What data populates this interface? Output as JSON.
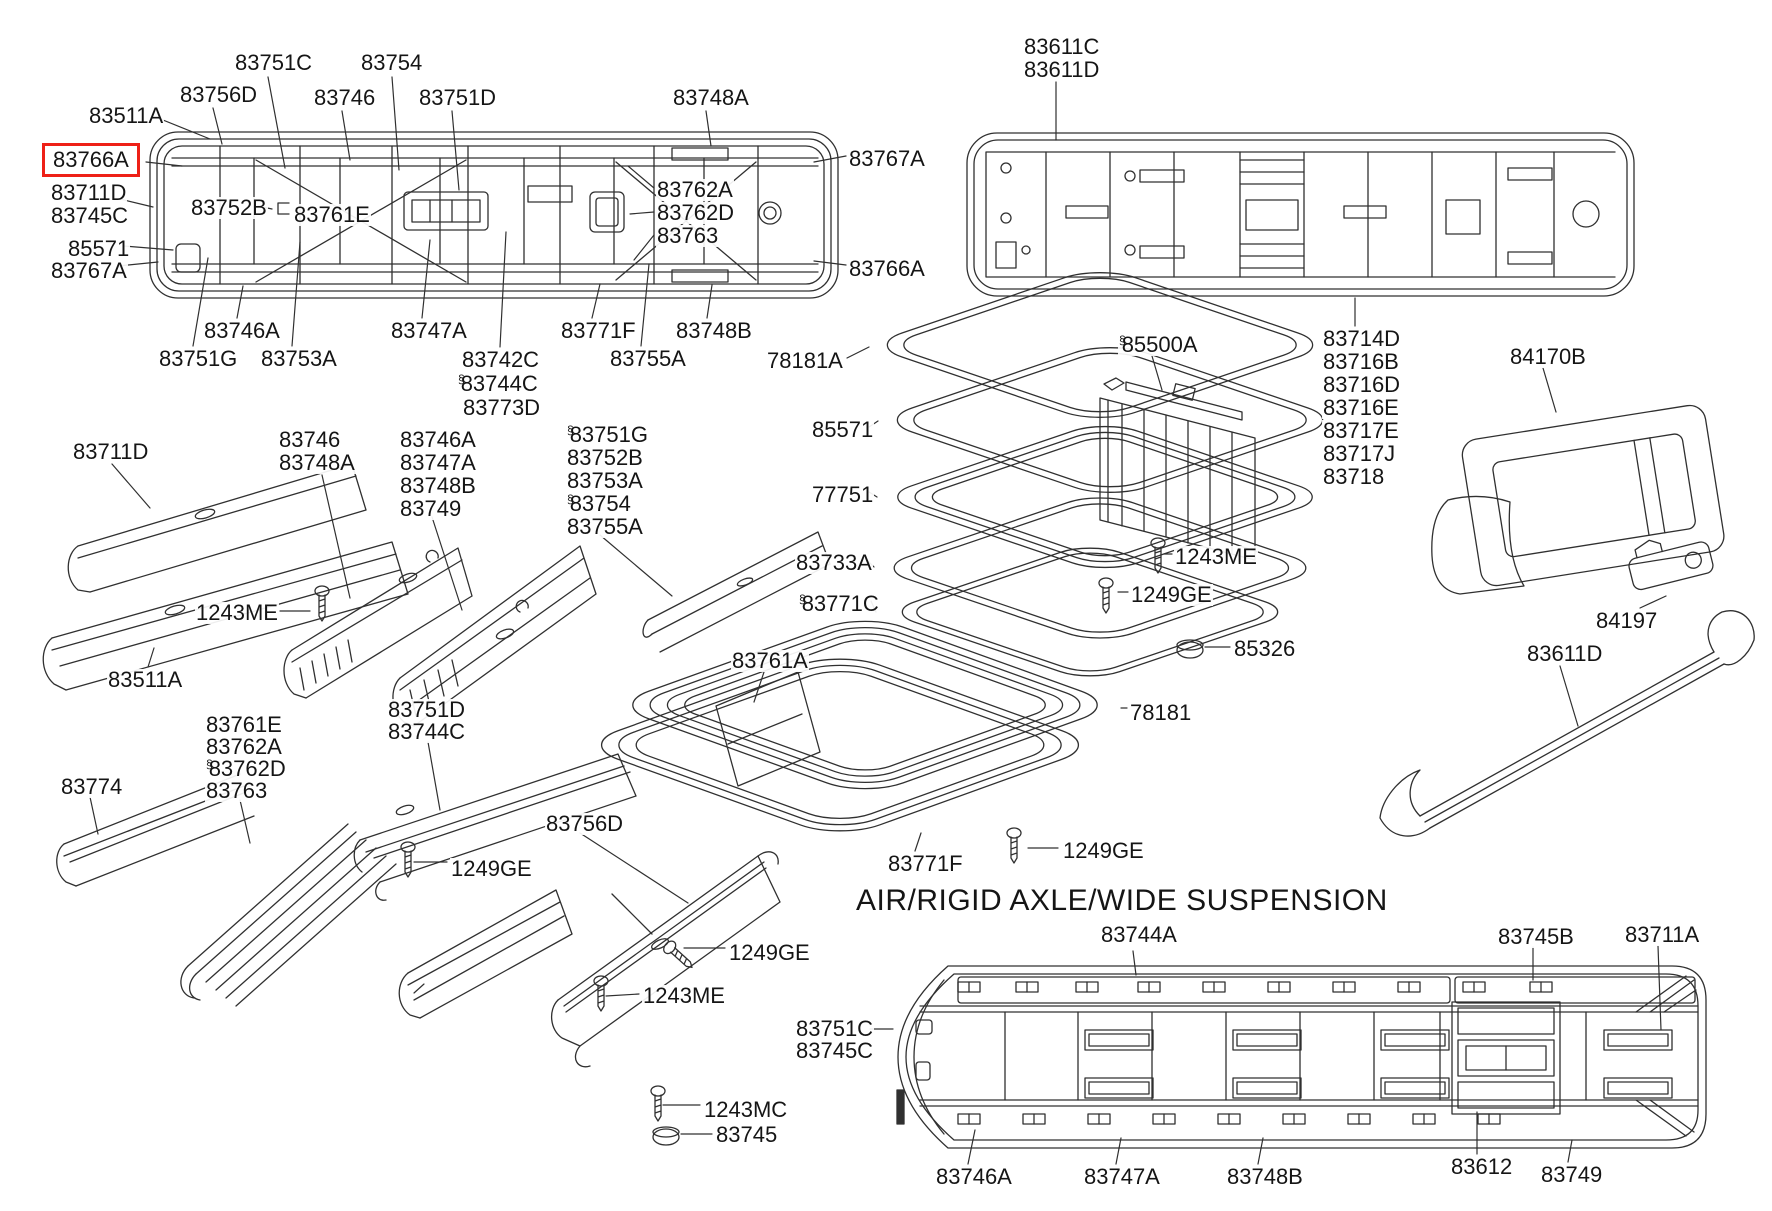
{
  "figure_type": "exploded-parts-diagram",
  "colors": {
    "background": "#ffffff",
    "line": "#303030",
    "text": "#151515",
    "highlight": "#ee2017"
  },
  "mark_symbol": "§",
  "section_heading": {
    "text": "AIR/RIGID AXLE/WIDE SUSPENSION",
    "x": 856,
    "y": 886
  },
  "highlighted_part": "83766A",
  "labels": [
    {
      "text": "83751C",
      "x": 234,
      "y": 52
    },
    {
      "text": "83754",
      "x": 360,
      "y": 52
    },
    {
      "text": "83756D",
      "x": 179,
      "y": 84
    },
    {
      "text": "83746",
      "x": 313,
      "y": 87
    },
    {
      "text": "83751D",
      "x": 418,
      "y": 87
    },
    {
      "text": "83748A",
      "x": 672,
      "y": 87
    },
    {
      "text": "83511A",
      "x": 88,
      "y": 105
    },
    {
      "text": "83766A",
      "x": 52,
      "y": 150,
      "highlighted": true
    },
    {
      "text": "83767A",
      "x": 848,
      "y": 148
    },
    {
      "text": "83711D",
      "x": 50,
      "y": 182
    },
    {
      "text": "83745C",
      "x": 50,
      "y": 205
    },
    {
      "text": "83752B",
      "x": 190,
      "y": 197
    },
    {
      "text": "83761E",
      "x": 293,
      "y": 204
    },
    {
      "text": "83762A",
      "x": 656,
      "y": 179
    },
    {
      "text": "83762D",
      "x": 656,
      "y": 202
    },
    {
      "text": "83763",
      "x": 656,
      "y": 225
    },
    {
      "text": "85571",
      "x": 67,
      "y": 238
    },
    {
      "text": "83767A",
      "x": 50,
      "y": 260
    },
    {
      "text": "83766A",
      "x": 848,
      "y": 258
    },
    {
      "text": "83746A",
      "x": 203,
      "y": 320
    },
    {
      "text": "83747A",
      "x": 390,
      "y": 320
    },
    {
      "text": "83771F",
      "x": 560,
      "y": 320
    },
    {
      "text": "83748B",
      "x": 675,
      "y": 320
    },
    {
      "text": "83751G",
      "x": 158,
      "y": 348
    },
    {
      "text": "83753A",
      "x": 260,
      "y": 348
    },
    {
      "text": "83742C",
      "x": 461,
      "y": 349
    },
    {
      "text": "83744C",
      "x": 457,
      "y": 373,
      "marked": true
    },
    {
      "text": "83773D",
      "x": 462,
      "y": 397
    },
    {
      "text": "83755A",
      "x": 609,
      "y": 348
    },
    {
      "text": "78181A",
      "x": 766,
      "y": 350
    },
    {
      "text": "83611C",
      "x": 1023,
      "y": 36
    },
    {
      "text": "83611D",
      "x": 1023,
      "y": 59
    },
    {
      "text": "83714D",
      "x": 1322,
      "y": 328
    },
    {
      "text": "83716B",
      "x": 1322,
      "y": 351
    },
    {
      "text": "83716D",
      "x": 1322,
      "y": 374
    },
    {
      "text": "83716E",
      "x": 1322,
      "y": 397
    },
    {
      "text": "83717E",
      "x": 1322,
      "y": 420
    },
    {
      "text": "83717J",
      "x": 1322,
      "y": 443
    },
    {
      "text": "83718",
      "x": 1322,
      "y": 466
    },
    {
      "text": "85500A",
      "x": 1118,
      "y": 334,
      "marked": true
    },
    {
      "text": "84170B",
      "x": 1509,
      "y": 346
    },
    {
      "text": "1243ME",
      "x": 1174,
      "y": 546
    },
    {
      "text": "1249GE",
      "x": 1130,
      "y": 584
    },
    {
      "text": "85326",
      "x": 1233,
      "y": 638
    },
    {
      "text": "84197",
      "x": 1595,
      "y": 610
    },
    {
      "text": "83611D",
      "x": 1526,
      "y": 643
    },
    {
      "text": "85571",
      "x": 811,
      "y": 419
    },
    {
      "text": "77751",
      "x": 811,
      "y": 484
    },
    {
      "text": "83733A",
      "x": 795,
      "y": 552
    },
    {
      "text": "83771C",
      "x": 798,
      "y": 593,
      "marked": true
    },
    {
      "text": "83761A",
      "x": 731,
      "y": 650
    },
    {
      "text": "78181",
      "x": 1129,
      "y": 702
    },
    {
      "text": "83771F",
      "x": 887,
      "y": 853
    },
    {
      "text": "1249GE",
      "x": 1062,
      "y": 840
    },
    {
      "text": "83711D",
      "x": 72,
      "y": 441
    },
    {
      "text": "83746",
      "x": 278,
      "y": 429
    },
    {
      "text": "83748A",
      "x": 278,
      "y": 452
    },
    {
      "text": "83746A",
      "x": 399,
      "y": 429
    },
    {
      "text": "83747A",
      "x": 399,
      "y": 452
    },
    {
      "text": "83748B",
      "x": 399,
      "y": 475
    },
    {
      "text": "83749",
      "x": 399,
      "y": 498
    },
    {
      "text": "83751G",
      "x": 566,
      "y": 424,
      "marked": true
    },
    {
      "text": "83752B",
      "x": 566,
      "y": 447
    },
    {
      "text": "83753A",
      "x": 566,
      "y": 470
    },
    {
      "text": "83754",
      "x": 566,
      "y": 493,
      "marked": true
    },
    {
      "text": "83755A",
      "x": 566,
      "y": 516
    },
    {
      "text": "1243ME",
      "x": 195,
      "y": 602
    },
    {
      "text": "83511A",
      "x": 107,
      "y": 669
    },
    {
      "text": "83761E",
      "x": 205,
      "y": 714
    },
    {
      "text": "83762A",
      "x": 205,
      "y": 736
    },
    {
      "text": "83762D",
      "x": 205,
      "y": 758,
      "marked": true
    },
    {
      "text": "83763",
      "x": 205,
      "y": 780
    },
    {
      "text": "83751D",
      "x": 387,
      "y": 699
    },
    {
      "text": "83744C",
      "x": 387,
      "y": 721
    },
    {
      "text": "83774",
      "x": 60,
      "y": 776
    },
    {
      "text": "1249GE",
      "x": 450,
      "y": 858
    },
    {
      "text": "83756D",
      "x": 545,
      "y": 813
    },
    {
      "text": "1249GE",
      "x": 728,
      "y": 942
    },
    {
      "text": "1243ME",
      "x": 642,
      "y": 985
    },
    {
      "text": "1243MC",
      "x": 703,
      "y": 1099
    },
    {
      "text": "83745",
      "x": 715,
      "y": 1124
    },
    {
      "text": "83744A",
      "x": 1100,
      "y": 924
    },
    {
      "text": "83745B",
      "x": 1497,
      "y": 926
    },
    {
      "text": "83711A",
      "x": 1624,
      "y": 924
    },
    {
      "text": "83751C",
      "x": 795,
      "y": 1018
    },
    {
      "text": "83745C",
      "x": 795,
      "y": 1040
    },
    {
      "text": "83746A",
      "x": 935,
      "y": 1166
    },
    {
      "text": "83747A",
      "x": 1083,
      "y": 1166
    },
    {
      "text": "83748B",
      "x": 1226,
      "y": 1166
    },
    {
      "text": "83612",
      "x": 1450,
      "y": 1156
    },
    {
      "text": "83749",
      "x": 1540,
      "y": 1164
    }
  ]
}
